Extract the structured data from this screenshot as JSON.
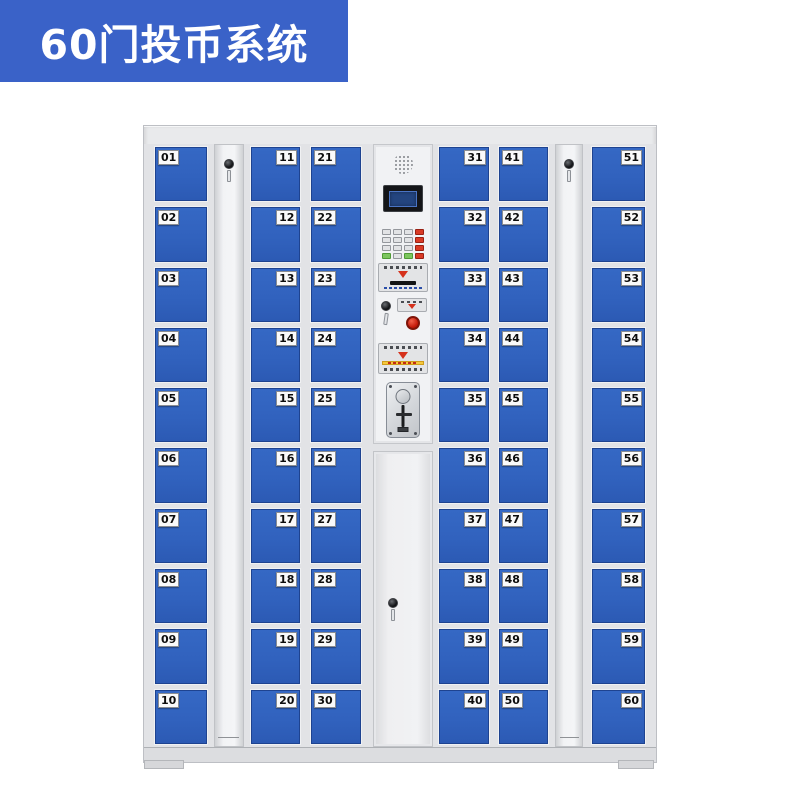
{
  "badge": {
    "label": "60门投币系统"
  },
  "colors": {
    "badge_bg": "#3A62C8",
    "badge_text": "#FFFFFF",
    "door_blue": "#3162BE",
    "cabinet_grey": "#E9EAEC",
    "panel_grey": "#F1F2F4",
    "red_button": "#C11505",
    "yellow_strip": "#F5C83C"
  },
  "locker": {
    "total_doors": 60,
    "columns": [
      {
        "id": "doors-01-10",
        "type": "doors",
        "label_side": "left",
        "doors": [
          "01",
          "02",
          "03",
          "04",
          "05",
          "06",
          "07",
          "08",
          "09",
          "10"
        ]
      },
      {
        "id": "lock-column-left",
        "type": "lock-panel"
      },
      {
        "id": "doors-11-20",
        "type": "doors",
        "label_side": "right",
        "doors": [
          "11",
          "12",
          "13",
          "14",
          "15",
          "16",
          "17",
          "18",
          "19",
          "20"
        ]
      },
      {
        "id": "doors-21-30",
        "type": "doors",
        "label_side": "left",
        "doors": [
          "21",
          "22",
          "23",
          "24",
          "25",
          "26",
          "27",
          "28",
          "29",
          "30"
        ]
      },
      {
        "id": "control-column",
        "type": "control"
      },
      {
        "id": "doors-31-40",
        "type": "doors",
        "label_side": "right",
        "doors": [
          "31",
          "32",
          "33",
          "34",
          "35",
          "36",
          "37",
          "38",
          "39",
          "40"
        ]
      },
      {
        "id": "doors-41-50",
        "type": "doors",
        "label_side": "left",
        "doors": [
          "41",
          "42",
          "43",
          "44",
          "45",
          "46",
          "47",
          "48",
          "49",
          "50"
        ]
      },
      {
        "id": "lock-column-right",
        "type": "lock-panel"
      },
      {
        "id": "doors-51-60",
        "type": "doors",
        "label_side": "right",
        "doors": [
          "51",
          "52",
          "53",
          "54",
          "55",
          "56",
          "57",
          "58",
          "59",
          "60"
        ]
      }
    ]
  }
}
